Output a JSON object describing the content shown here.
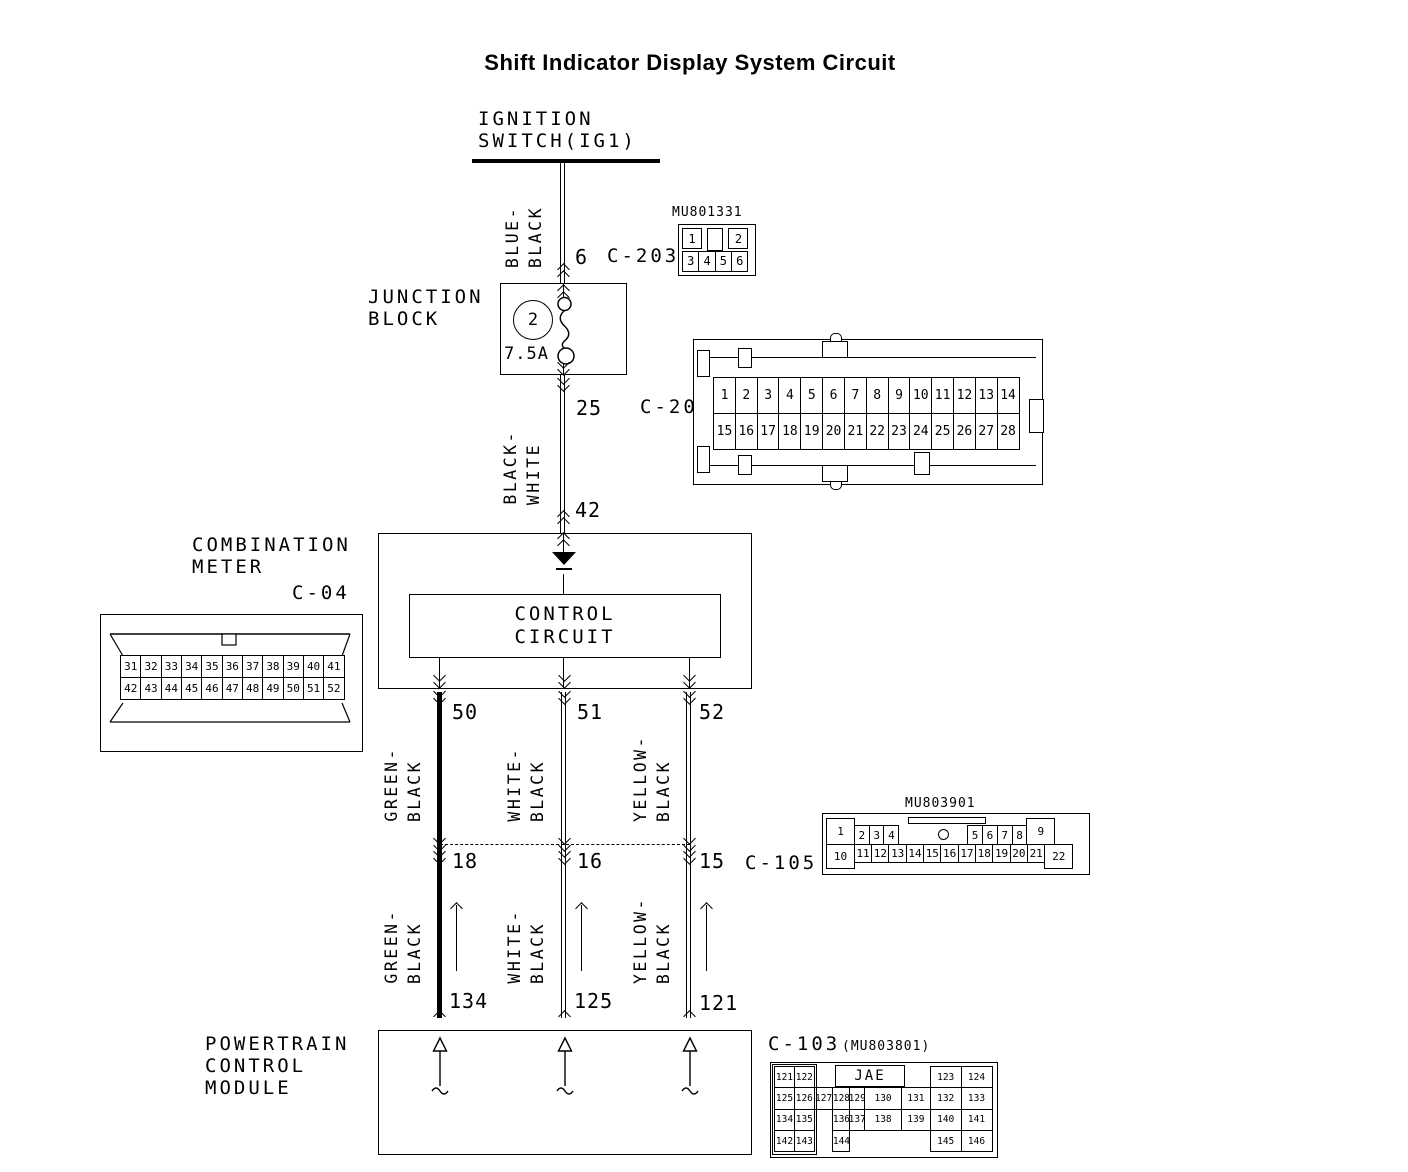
{
  "title": "Shift Indicator Display System Circuit",
  "colors": {
    "line": "#000000",
    "background": "#ffffff"
  },
  "ignition_switch": {
    "line1": "IGNITION",
    "line2": "SWITCH(IG1)"
  },
  "junction_block": {
    "line1": "JUNCTION",
    "line2": "BLOCK",
    "fuse_number": "2",
    "fuse_rating": "7.5A"
  },
  "combination_meter": {
    "line1": "COMBINATION",
    "line2": "METER",
    "connector": "C-04",
    "control_line1": "CONTROL",
    "control_line2": "CIRCUIT"
  },
  "pcm": {
    "line1": "POWERTRAIN",
    "line2": "CONTROL",
    "line3": "MODULE"
  },
  "wires": {
    "blue_black": {
      "w1": "BLUE-",
      "w2": "BLACK"
    },
    "black_white": {
      "w1": "BLACK-",
      "w2": "WHITE"
    },
    "green_black": {
      "w1": "GREEN-",
      "w2": "BLACK"
    },
    "white_black": {
      "w1": "WHITE-",
      "w2": "BLACK"
    },
    "yellow_black": {
      "w1": "YELLOW-",
      "w2": "BLACK"
    }
  },
  "refs": {
    "c203_pin": "6",
    "c203_name": "C-203",
    "c205_pin": "25",
    "c205_name": "C-205",
    "meter_pin": "42",
    "out_pin1": "50",
    "out_pin2": "51",
    "out_pin3": "52",
    "c105_pin1": "18",
    "c105_pin2": "16",
    "c105_pin3": "15",
    "c105_name": "C-105",
    "pcm_pin1": "134",
    "pcm_pin2": "125",
    "pcm_pin3": "121",
    "c103_name": "C-103",
    "c103_part": "(MU803801)"
  },
  "connectors": {
    "mu801331": {
      "label": "MU801331",
      "rows": [
        [
          "1",
          "",
          "2"
        ],
        [
          "3",
          "4",
          "5",
          "6"
        ]
      ]
    },
    "c205_view": {
      "rows": [
        [
          "1",
          "2",
          "3",
          "4",
          "5",
          "6",
          "7",
          "8",
          "9",
          "10",
          "11",
          "12",
          "13",
          "14"
        ],
        [
          "15",
          "16",
          "17",
          "18",
          "19",
          "20",
          "21",
          "22",
          "23",
          "24",
          "25",
          "26",
          "27",
          "28"
        ]
      ]
    },
    "c04_view": {
      "rows": [
        [
          "31",
          "32",
          "33",
          "34",
          "35",
          "36",
          "37",
          "38",
          "39",
          "40",
          "41"
        ],
        [
          "42",
          "43",
          "44",
          "45",
          "46",
          "47",
          "48",
          "49",
          "50",
          "51",
          "52"
        ]
      ]
    },
    "mu803901": {
      "label": "MU803901",
      "rows": [
        [
          "1",
          "2",
          "3",
          "4",
          null,
          "5",
          "6",
          "7",
          "8",
          "9"
        ],
        [
          "10",
          "11",
          "12",
          "13",
          "14",
          "15",
          "16",
          "17",
          "18",
          "19",
          "20",
          "21",
          "22"
        ]
      ]
    },
    "c103_view": {
      "maker": "JAE",
      "rows": [
        [
          "121",
          "122",
          null,
          null,
          null,
          null,
          null,
          "123",
          "124"
        ],
        [
          "125",
          "126",
          "127",
          "128",
          "129",
          "130",
          "131",
          "132",
          "133"
        ],
        [
          "134",
          "135",
          null,
          "136",
          "137",
          "138",
          "139",
          "140",
          "141"
        ],
        [
          "142",
          "143",
          null,
          "144",
          null,
          null,
          null,
          "145",
          "146"
        ]
      ]
    }
  }
}
